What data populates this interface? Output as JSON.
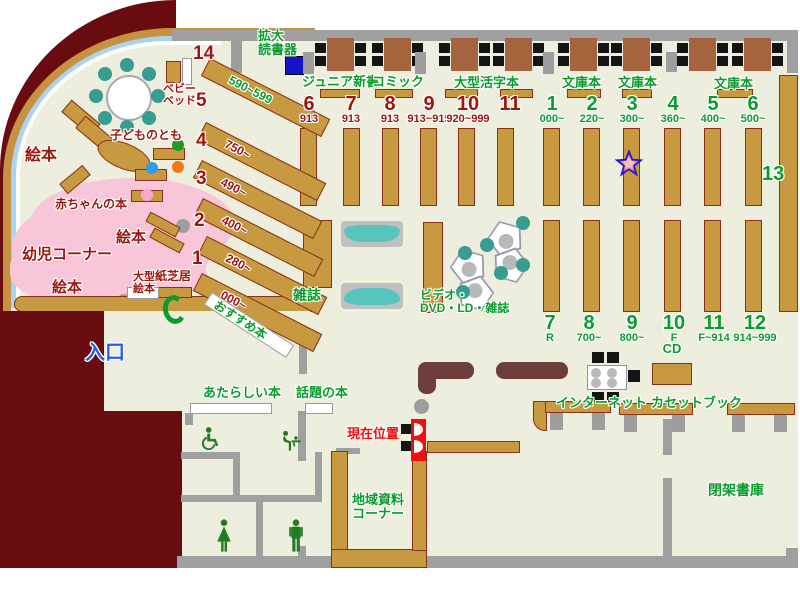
{
  "colors": {
    "wall_gray": "#a0a0a0",
    "maroon": "#680c10",
    "floor_beige": "#edeedd",
    "shelf_tan": "#c79a42",
    "pink_area": "#f8c6d8",
    "green_label": "#0b9c2d",
    "dark_red_label": "#9e150d",
    "entrance_blue": "#2561e6",
    "marker_red": "#ee0f0f",
    "teal": "#58c5bd",
    "table_brown": "#a5643e",
    "device_blue": "#1414cc",
    "star_blue": "#2017d6"
  },
  "areas": {
    "magnifier": "拡大\n読書器",
    "junior_shinsho": "ジュニア新書",
    "comics": "コミック",
    "large_print": "大型活字本",
    "bunko_1": "文庫本",
    "bunko_2": "文庫本",
    "bunko_3": "文庫本",
    "baby_bed": "ベビー\nベッド",
    "kodomo_no_tomo": "子どものとも",
    "picture_books_1": "絵本",
    "picture_books_2": "絵本",
    "picture_books_3": "絵本",
    "baby_books": "赤ちゃんの本",
    "kids_corner": "幼児コーナー",
    "large_picture_books": "大型\n絵本",
    "kamishibai": "紙芝居",
    "magazines": "雑誌",
    "recommended": "おすすめ本",
    "av_corner": "ビデオ・\nDVD・LD・雑誌",
    "entrance": "入口",
    "new_books": "あたらしい本",
    "topic_books": "話題の本",
    "current_location": "現在位置",
    "local_materials": "地域資料\nコーナー",
    "internet": "インターネット",
    "cd": "CD",
    "cassette_books": "カセットブック",
    "closed_stacks": "閉架書庫",
    "shelf_13": "13"
  },
  "numbers": {
    "top_left": [
      {
        "n": "6",
        "s": "913"
      },
      {
        "n": "7",
        "s": "913"
      },
      {
        "n": "8",
        "s": "913"
      },
      {
        "n": "9",
        "s": "913~919"
      },
      {
        "n": "10",
        "s": "920~999"
      },
      {
        "n": "11",
        "s": ""
      }
    ],
    "top_right": [
      {
        "n": "1",
        "s": "000~"
      },
      {
        "n": "2",
        "s": "220~"
      },
      {
        "n": "3",
        "s": "300~"
      },
      {
        "n": "4",
        "s": "360~"
      },
      {
        "n": "5",
        "s": "400~"
      },
      {
        "n": "6",
        "s": "500~"
      }
    ],
    "bottom_right": [
      {
        "n": "7",
        "s": "R"
      },
      {
        "n": "8",
        "s": "700~"
      },
      {
        "n": "9",
        "s": "800~"
      },
      {
        "n": "10",
        "s": "F"
      },
      {
        "n": "11",
        "s": "F~914"
      },
      {
        "n": "12",
        "s": "914~999"
      }
    ]
  },
  "diagonal_shelves": [
    {
      "n": "14",
      "range": "590~599"
    },
    {
      "n": "5",
      "range": "750~"
    },
    {
      "n": "4",
      "range": "490~"
    },
    {
      "n": "3",
      "range": "400~"
    },
    {
      "n": "2",
      "range": "280~"
    },
    {
      "n": "1",
      "range": "000~"
    }
  ]
}
